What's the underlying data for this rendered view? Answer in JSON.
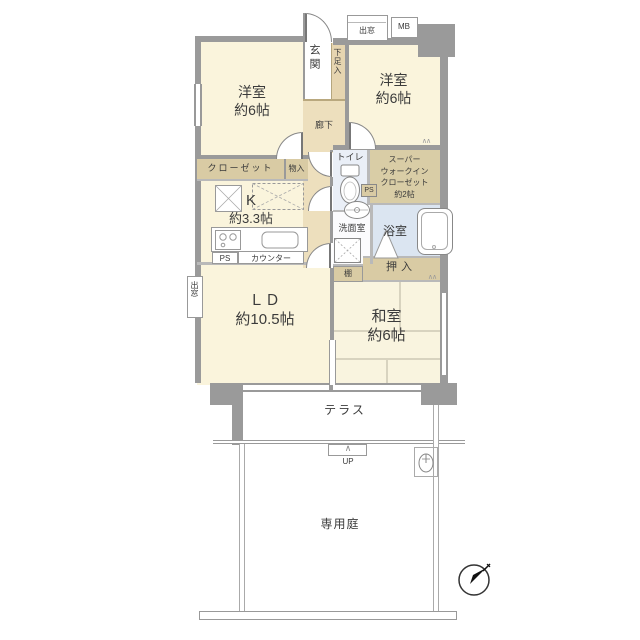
{
  "floorplan": {
    "rooms": {
      "bedroom_left": {
        "name": "洋室",
        "size": "約6帖"
      },
      "bedroom_right": {
        "name": "洋室",
        "size": "約6帖"
      },
      "kitchen": {
        "name": "K",
        "size": "約3.3帖"
      },
      "living_dining": {
        "name": "ＬＤ",
        "size": "約10.5帖"
      },
      "japanese_room": {
        "name": "和室",
        "size": "約6帖"
      },
      "walk_in_closet": {
        "line1": "スーパー",
        "line2": "ウォークイン",
        "line3": "クローゼット",
        "size": "約2帖"
      },
      "entrance": "玄関",
      "shoe_storage": "下足入",
      "hallway": "廊下",
      "closet": "クローゼット",
      "storage": "物入",
      "counter": "カウンター",
      "toilet": "トイレ",
      "washroom": "洗面室",
      "bathroom": "浴室",
      "shelf": "棚",
      "futon_closet": "押入",
      "terrace": "テラス",
      "private_garden": "専用庭"
    },
    "marks": {
      "ps": "PS",
      "mb": "MB",
      "bay_window": "出窓",
      "up": "UP",
      "up_arrow": "∧",
      "vent": "∧∧"
    },
    "colors": {
      "wall": "#9a9a9a",
      "room_cream": "#faf4dc",
      "hall_tan": "#eddfbd",
      "closet_tan": "#d9cba4",
      "bath_blue": "#dbe5f1",
      "toilet_blue": "#eaeff7",
      "tatami_line": "#d8d3bf"
    }
  }
}
